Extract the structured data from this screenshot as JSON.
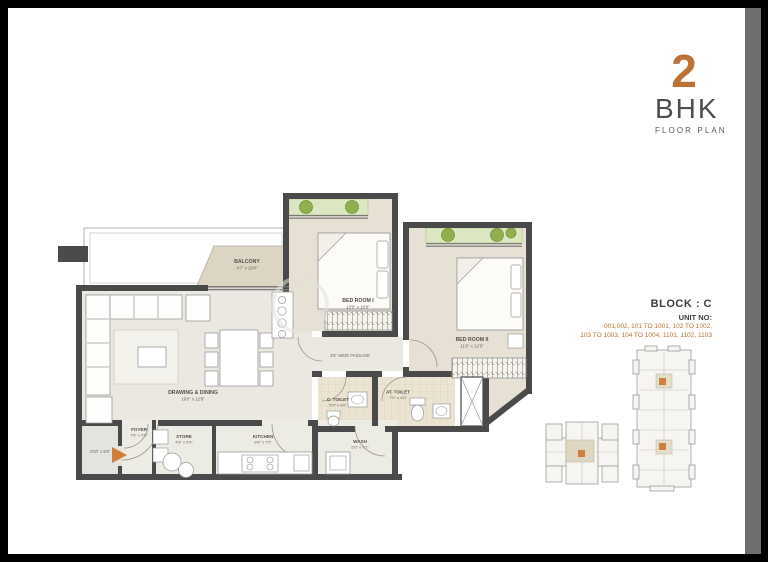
{
  "header": {
    "number": "2",
    "type": "BHK",
    "subtitle": "FLOOR PLAN"
  },
  "block_info": {
    "block": "BLOCK : C",
    "unit_label": "UNIT NO:",
    "units_line1": "001,002, 101 TO 1001, 102 TO 1002,",
    "units_line2": "103 TO 1003, 104 TO 1004, 1101, 1102, 1103"
  },
  "rooms": {
    "drawing_dining": {
      "name": "DRAWING & DINING",
      "dim": "19'0\" x 12'8\""
    },
    "balcony": {
      "name": "BALCONY",
      "dim": "4'7\" x 20'0\""
    },
    "bedroom1": {
      "name": "BED ROOM I",
      "dim": "13'0\" x 10'6\""
    },
    "bedroom2": {
      "name": "BED ROOM II",
      "dim": "11'6\" x 12'0\""
    },
    "c_toilet": {
      "name": "C. TOILET",
      "dim": "5'0\" x 4'0\""
    },
    "at_toilet": {
      "name": "AT. TOILET",
      "dim": "7'0\" x 4'0\""
    },
    "foyer": {
      "name": "FOYER",
      "dim": "7'6\" x 5'0\""
    },
    "store": {
      "name": "STORE",
      "dim": "4'6\" x 5'9\""
    },
    "kitchen": {
      "name": "KITCHEN",
      "dim": "9'8\" x 7'5\""
    },
    "wash": {
      "name": "WASH",
      "dim": "5'9\" x 7'7\""
    },
    "passage": {
      "name": "3'6\" WIDE PASSAGE"
    },
    "entry": {
      "dim": "4'10\" x 5'5\""
    }
  },
  "colors": {
    "accent": "#bd7134",
    "wall": "#4a4a4a",
    "living_floor": "#eae8e0",
    "bedroom_floor": "#e6e1d4",
    "balcony_floor": "#ddd5c3",
    "planter": "#dce7c2",
    "bush": "#8fb04c",
    "side_band": "#6e6e6e"
  }
}
